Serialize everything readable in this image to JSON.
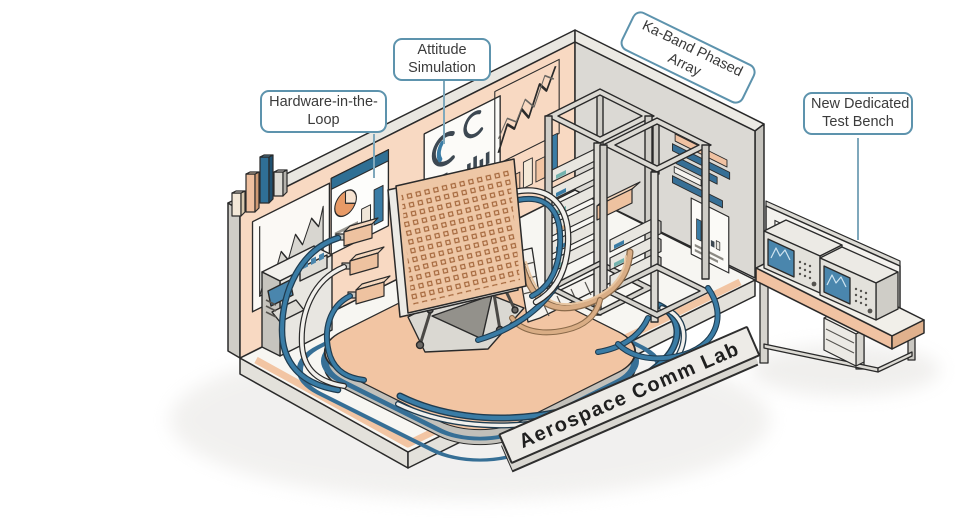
{
  "figure_title": "Aerospace Comm Lab",
  "callouts": {
    "hardware_in_the_loop": {
      "line1": "Hardware-in-the-",
      "line2": "Loop"
    },
    "attitude_simulation": {
      "line1": "Attitude",
      "line2": "Simulation"
    },
    "ka_band_phased_array": {
      "line1": "Ka-Band Phased",
      "line2": "Array"
    },
    "new_dedicated_test_bench": {
      "line1": "New Dedicated",
      "line2": "Test Bench"
    }
  },
  "palette": {
    "wall_peach": "#f8d9c2",
    "floor_white": "#f7f6f2",
    "back_wall_gray": "#dbd9d4",
    "platform_peach": "#f2c5a3",
    "array_panel_peach": "#eec7a6",
    "accent_blue": "#3a7ca5",
    "cable_blue": "#366f96",
    "tan_cable": "#d9ad85",
    "label_border_blue": "#5d93ad",
    "outline": "#2a2a2a"
  },
  "objects": [
    "isometric-lab-room",
    "iso-bar-chart-icon",
    "wall-area-chart",
    "wall-dashboard-panel",
    "hardware-in-the-loop-console",
    "attitude-gauge-panel",
    "wall-line-chart",
    "wall-mini-bars",
    "phased-array-panel",
    "hexapod-motion-platform",
    "cable-bundles",
    "cable-tray",
    "server-rack-left",
    "server-rack-right",
    "back-wall-stripes",
    "back-wall-chart",
    "test-bench",
    "spectrum-analyzer-1",
    "spectrum-analyzer-2",
    "name-plate"
  ]
}
